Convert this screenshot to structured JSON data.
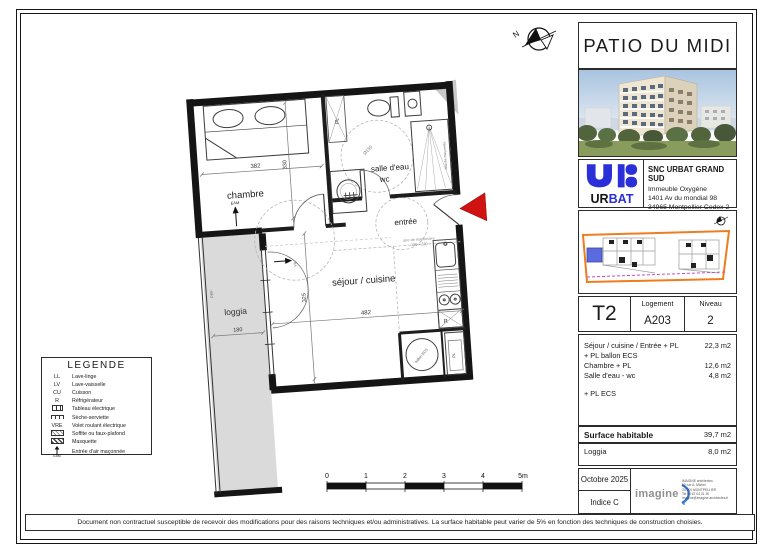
{
  "project": {
    "title": "PATIO DU MIDI"
  },
  "developer": {
    "company": "SNC URBAT GRAND SUD",
    "brand_black": "UR",
    "brand_blue": "BAT",
    "address_line1": "Immeuble Oxygène",
    "address_line2": "1401 Av du mondial 98",
    "address_line3": "34965 Montpellier Cedex 2",
    "address_line4": "Tél 04.67.14.13.12"
  },
  "unit_table": {
    "type": "T2",
    "logement_label": "Logement",
    "logement_value": "A203",
    "niveau_label": "Niveau",
    "niveau_value": "2"
  },
  "surfaces": {
    "rows": [
      {
        "label": "Séjour / cuisine / Entrée + PL",
        "value": "22,3 m2"
      },
      {
        "label": "+ PL ballon ECS",
        "value": ""
      },
      {
        "label": "Chambre  + PL",
        "value": "12,6 m2"
      },
      {
        "label": "Salle d'eau - wc",
        "value": "4,8 m2"
      },
      {
        "label": "+ PL ECS",
        "value": ""
      }
    ],
    "habitable_label": "Surface habitable",
    "habitable_value": "39,7 m2",
    "loggia_label": "Loggia",
    "loggia_value": "8,0 m2"
  },
  "revision": {
    "date": "Octobre 2025",
    "indice": "Indice C"
  },
  "architect": {
    "logo": "imagine",
    "lines": [
      "IMAGINE architectes",
      "50 rue A. Michel",
      "34 000 MONTPELLIER",
      "Tel 04 67 04 31 30",
      "imagine@imagine-architectes.fr"
    ]
  },
  "legend": {
    "title": "LEGENDE",
    "items": [
      {
        "key": "LL",
        "icon": "",
        "label": "Lave-linge"
      },
      {
        "key": "LV",
        "icon": "",
        "label": "Lave-vaisselle"
      },
      {
        "key": "CU",
        "icon": "",
        "label": "Cuisson"
      },
      {
        "key": "R",
        "icon": "",
        "label": "Réfrigérateur"
      },
      {
        "key": "",
        "icon": "electric-panel-icon",
        "label": "Tableau électrique"
      },
      {
        "key": "",
        "icon": "towel-radiator-icon",
        "label": "Sèche-serviette"
      },
      {
        "key": "VRE",
        "icon": "",
        "label": "Volet roulant électrique"
      },
      {
        "key": "",
        "icon": "hatch-light-icon",
        "label": "Soffite ou faux-plafond"
      },
      {
        "key": "",
        "icon": "hatch-dark-icon",
        "label": "Masquette"
      },
      {
        "key": "EAM",
        "icon": "air-inlet-icon",
        "label": "Entrée d'air maçonnée"
      }
    ]
  },
  "plan": {
    "rooms": {
      "chambre": "chambre",
      "salle_deau": "salle d'eau",
      "wc": "wc",
      "entree": "entrée",
      "sejour": "séjour / cuisine",
      "loggia": "loggia"
    },
    "labels": {
      "pl": "PL",
      "eam": "EAM",
      "ballon_ecs": "ballon ECS",
      "refrigerateur": "R",
      "douche": "douche maçonnée",
      "ppf": "PPF",
      "vr": "VR",
      "aire1": "aire de manoeuvre",
      "aire2": "120 x 220",
      "diam": "Ø150",
      "north": "N"
    },
    "dims": {
      "chambre_w": "382",
      "chambre_h": "330",
      "sejour_w": "482",
      "sejour_h": "325",
      "loggia_w": "180"
    }
  },
  "scale_bar": {
    "ticks": [
      "0",
      "1",
      "2",
      "3",
      "4",
      "5m"
    ]
  },
  "colors": {
    "brand_blue": "#2b2fd8",
    "siteplan_orange": "#ee7d1e",
    "unit_highlight_blue": "#5b6ade",
    "limit_dashed_purple": "#c24fd4",
    "entrance_arrow_red": "#cf1212",
    "loggia_gray": "#dadada"
  },
  "disclaimer": "Document non contractuel susceptible de recevoir des modifications pour des raisons techniques et/ou administratives. La surface habitable peut varier de 5% en fonction des techniques de construction choisies."
}
